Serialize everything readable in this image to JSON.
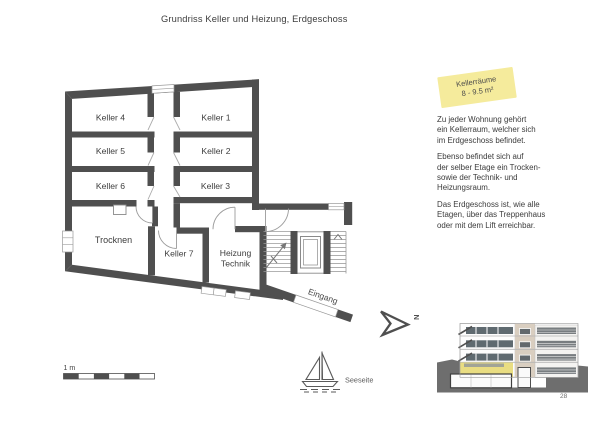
{
  "page": {
    "title": "Grundriss Keller und Heizung, Erdgeschoss",
    "number": "28"
  },
  "note": {
    "title": "Kellerräume",
    "area": "8 - 9.5 m²"
  },
  "plan": {
    "keller1": "Keller 1",
    "keller2": "Keller 2",
    "keller3": "Keller 3",
    "keller4": "Keller 4",
    "keller5": "Keller 5",
    "keller6": "Keller 6",
    "keller7": "Keller 7",
    "trocknen": "Trocknen",
    "heizung_line1": "Heizung",
    "heizung_line2": "Technik",
    "eingang": "Eingang",
    "north": "N"
  },
  "description": {
    "para1": "Zu jeder Wohnung gehört\nein Kellerraum, welcher sich\nim Erdgeschoss befindet.",
    "para2": "Ebenso befindet sich auf\nder selber Etage ein Trocken-\nsowie der Technik- und\nHeizungsraum.",
    "para3": "Das Erdgeschoss ist, wie alle\nEtagen, über das Treppenhaus\noder mit dem Lift erreichbar."
  },
  "scale": {
    "label": "1 m"
  },
  "orientation": {
    "label": "Seeseite"
  },
  "icons": {
    "north_arrow": "north-arrow-icon",
    "sailboat": "sailboat-icon"
  },
  "colors": {
    "wall": "#4f4f4f",
    "note_background": "#f5eb9c",
    "elevation_ground_floor_highlight": "#e9dd82",
    "terrain": "#6e6e6e"
  }
}
